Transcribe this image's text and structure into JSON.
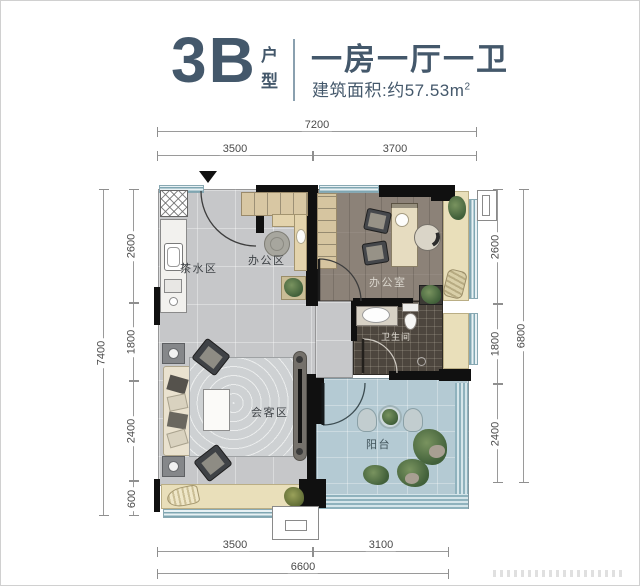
{
  "header": {
    "unit_code": "3B",
    "unit_type_label": "户型",
    "layout_summary": "一房一厅一卫",
    "area_prefix": "建筑面积:约57.53m",
    "area_sup": "2"
  },
  "dimensions": {
    "top_total": "7200",
    "top_left": "3500",
    "top_right": "3700",
    "left_total": "7400",
    "left_seg1": "2600",
    "left_seg2": "1800",
    "left_seg3": "2400",
    "left_seg4": "600",
    "right_seg1": "2600",
    "right_seg2": "1800",
    "right_seg3": "2400",
    "right_total": "6800",
    "bottom_left": "3500",
    "bottom_right": "3100",
    "bottom_total": "6600"
  },
  "rooms": {
    "tea_area": "茶水区",
    "office_area": "办公区",
    "office_room": "办公室",
    "bathroom": "卫生间",
    "meeting_area": "会客区",
    "balcony": "阳台"
  },
  "colors": {
    "accent": "#44586b",
    "wall": "#101010",
    "floor_gray": "#c6c7c9",
    "floor_wood": "#8c8278",
    "floor_bath": "#4d463e",
    "floor_balcony": "#b4cad3",
    "bay_beige": "#e9dfba",
    "window_teal": "#7fa6b2"
  }
}
